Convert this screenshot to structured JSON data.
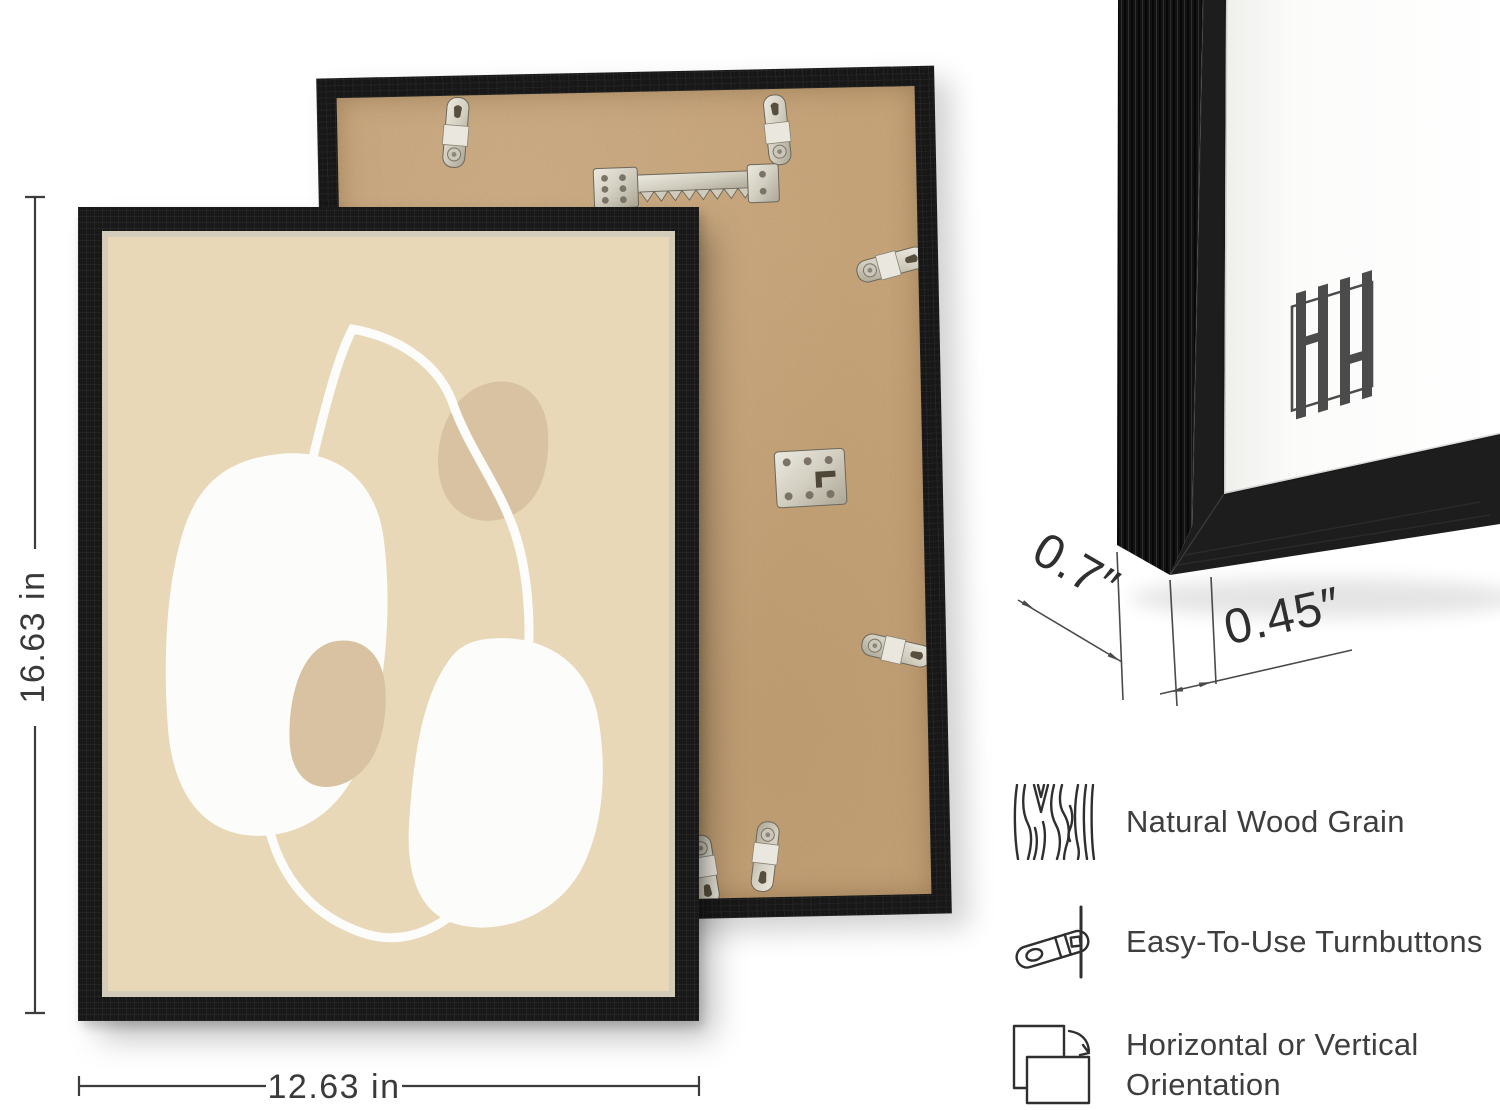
{
  "product_image": {
    "dimensions": {
      "frame_height": "16.63 in",
      "frame_width": "12.63 in",
      "frame_depth": "0.7″",
      "frame_face_width": "0.45″"
    },
    "features": [
      {
        "icon": "wood-grain-icon",
        "label": "Natural Wood Grain"
      },
      {
        "icon": "turnbutton-icon",
        "label": "Easy-To-Use Turnbuttons"
      },
      {
        "icon": "orientation-icon",
        "label": "Horizontal or Vertical Orientation",
        "label_lines": [
          "Horizontal or Vertical",
          "Orientation"
        ]
      }
    ],
    "brand": {
      "monogram": "HH"
    },
    "colors": {
      "page_background": "#ffffff",
      "frame_black": "#181818",
      "art_background": "#e8d8b8",
      "art_shape_tan": "#d9c2a2",
      "art_shape_white": "#fcfcfa",
      "mdf_back": "#c49f73",
      "metal_hardware": "#d8d4c7",
      "dimension_text": "#3a3a3a",
      "label_text": "#3e3e3e"
    }
  }
}
